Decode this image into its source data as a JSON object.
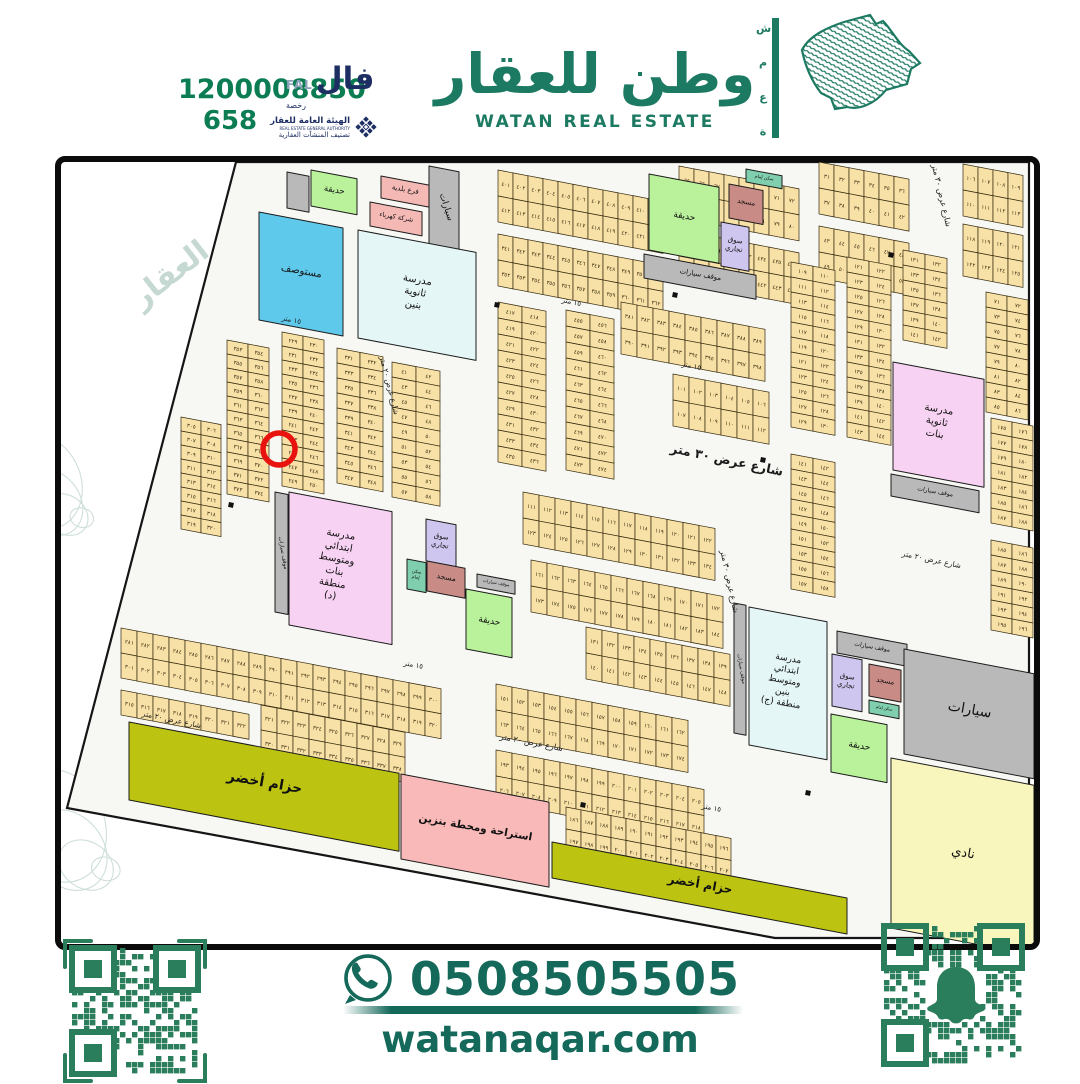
{
  "header": {
    "unified_number": "1200008850",
    "license_number": "658",
    "fal_logo": {
      "arabic": "فال",
      "latin": "FAL",
      "sub": "رخصة"
    },
    "authority": {
      "line1": "الهيئة العامة للعقار",
      "line2": "REAL ESTATE GENERAL AUTHORITY",
      "line3": "تصنيف المنشآت العقارية"
    },
    "brand_title_ar": "وطن للعقار",
    "brand_title_en": "WATAN REAL ESTATE",
    "brand_side_word": [
      "ش",
      "م",
      "ع",
      "ة"
    ],
    "brand_color": "#1d7a62",
    "phone_color": "#0c7d52",
    "navy_color": "#1d2e63"
  },
  "footer": {
    "whatsapp_phone": "0508505505",
    "website": "watanaqar.com",
    "qr_left_name": "qr-code",
    "qr_right_name": "snapchat-qr-code",
    "text_color": "#15695a",
    "qr_color": "#2b7e5c"
  },
  "map": {
    "colors": {
      "parcel": "#f8e1a6",
      "parcel_stroke": "#33290f",
      "street_bg": "#f7f7f4",
      "park": "#b9f29b",
      "clinic": "#5fc9ec",
      "school_cyan": "#e4f6f6",
      "school_pink": "#f8d2f3",
      "mosque": "#c98b85",
      "market": "#cfc6ef",
      "utility_pink": "#f4b9b5",
      "gas": "#f9b9b8",
      "belt": "#bcc411",
      "club": "#f8f6bd",
      "parking": "#b9b9b9",
      "imam": "#7fceae",
      "marker": "#e8120f",
      "watermark": "#9fbfb3"
    },
    "boundary": "175,0 968,0 968,776 714,776 6,646",
    "watermark_text": "العقار",
    "red_circle": {
      "x": 218,
      "y": 287,
      "r": 16
    },
    "facilities": [
      {
        "id": "park-top-left",
        "label": [
          "حديقة"
        ],
        "color": "park",
        "x": 250,
        "y": 8,
        "w": 46,
        "h": 36,
        "fs": 8.5
      },
      {
        "id": "gray-box-top-left",
        "label": [],
        "color": "parking",
        "x": 226,
        "y": 10,
        "w": 22,
        "h": 36,
        "fs": 0
      },
      {
        "id": "municipality-branch",
        "label": [
          "فرع بلدية"
        ],
        "color": "utility_pink",
        "x": 320,
        "y": 14,
        "w": 48,
        "h": 22,
        "fs": 7
      },
      {
        "id": "electricity-company",
        "label": [
          "شركة كهرباء"
        ],
        "color": "utility_pink",
        "x": 309,
        "y": 40,
        "w": 52,
        "h": 24,
        "fs": 6.5
      },
      {
        "id": "parking-strip-top-left",
        "label": [
          "سيارات"
        ],
        "color": "parking",
        "x": 368,
        "y": 4,
        "w": 30,
        "h": 78,
        "fs": 9,
        "lrot": 72
      },
      {
        "id": "clinic",
        "label": [
          "مستوصف"
        ],
        "color": "clinic",
        "x": 198,
        "y": 50,
        "w": 84,
        "h": 108,
        "fs": 10
      },
      {
        "id": "school-boys-high",
        "label": [
          "مدرسة",
          "ثانوية",
          "بنين"
        ],
        "color": "school_cyan",
        "x": 297,
        "y": 68,
        "w": 118,
        "h": 108,
        "fs": 10
      },
      {
        "id": "park-top-center",
        "label": [
          "حديقة"
        ],
        "color": "park",
        "x": 588,
        "y": 12,
        "w": 70,
        "h": 76,
        "fs": 9
      },
      {
        "id": "imam-house-top",
        "label": [
          "سكن إمام"
        ],
        "color": "imam",
        "x": 685,
        "y": 7,
        "w": 36,
        "h": 13,
        "fs": 4.5
      },
      {
        "id": "mosque-top-center",
        "label": [
          "مسجد"
        ],
        "color": "mosque",
        "x": 668,
        "y": 22,
        "w": 34,
        "h": 34,
        "fs": 7
      },
      {
        "id": "market-top-center",
        "label": [
          "سوق",
          "تجاري"
        ],
        "color": "market",
        "x": 660,
        "y": 60,
        "w": 28,
        "h": 44,
        "fs": 7
      },
      {
        "id": "parking-top-center",
        "label": [
          "موقف سيارات"
        ],
        "color": "parking",
        "x": 583,
        "y": 92,
        "w": 112,
        "h": 24,
        "fs": 7
      },
      {
        "id": "school-girls-high",
        "label": [
          "مدرسة",
          "ثانوية",
          "بنات"
        ],
        "color": "school_pink",
        "x": 832,
        "y": 200,
        "w": 91,
        "h": 108,
        "fs": 10
      },
      {
        "id": "parking-girls-school",
        "label": [
          "موقف سيارات"
        ],
        "color": "parking",
        "x": 830,
        "y": 312,
        "w": 88,
        "h": 22,
        "fs": 6
      },
      {
        "id": "school-district-d",
        "label": [
          "مدرسة",
          "ابتدائي",
          "ومتوسط",
          "بنات",
          "منطقة",
          "(د)"
        ],
        "color": "school_pink",
        "x": 228,
        "y": 330,
        "w": 103,
        "h": 133,
        "fs": 10
      },
      {
        "id": "parking-strip-district-d",
        "label": [
          "موقف سيارات"
        ],
        "color": "parking",
        "x": 214,
        "y": 330,
        "w": 13,
        "h": 120,
        "fs": 5.5,
        "lrot": 80
      },
      {
        "id": "market-center",
        "label": [
          "سوق",
          "تجاري"
        ],
        "color": "market",
        "x": 365,
        "y": 357,
        "w": 30,
        "h": 42,
        "fs": 7
      },
      {
        "id": "imam-house-center",
        "label": [
          "سكن",
          "إمام"
        ],
        "color": "imam",
        "x": 346,
        "y": 397,
        "w": 19,
        "h": 30,
        "fs": 4.5
      },
      {
        "id": "mosque-center",
        "label": [
          "مسجد"
        ],
        "color": "mosque",
        "x": 366,
        "y": 399,
        "w": 38,
        "h": 30,
        "fs": 7.5
      },
      {
        "id": "parking-center",
        "label": [
          "موقف سيارات"
        ],
        "color": "parking",
        "x": 416,
        "y": 412,
        "w": 38,
        "h": 13,
        "fs": 4.5
      },
      {
        "id": "park-center",
        "label": [
          "حديقة"
        ],
        "color": "park",
        "x": 405,
        "y": 427,
        "w": 46,
        "h": 60,
        "fs": 9
      },
      {
        "id": "school-district-j",
        "label": [
          "مدرسة",
          "ابتدائي",
          "ومتوسط",
          "بنين",
          "منطقة (ج)"
        ],
        "color": "school_cyan",
        "x": 688,
        "y": 445,
        "w": 78,
        "h": 138,
        "fs": 9
      },
      {
        "id": "parking-strip-district-j",
        "label": [
          "موقف سيارات"
        ],
        "color": "parking",
        "x": 673,
        "y": 441,
        "w": 12,
        "h": 130,
        "fs": 5,
        "lrot": 80
      },
      {
        "id": "parking-district-j",
        "label": [
          "موقف سيارات"
        ],
        "color": "parking",
        "x": 776,
        "y": 469,
        "w": 70,
        "h": 22,
        "fs": 6
      },
      {
        "id": "market-district-j",
        "label": [
          "سوق",
          "تجاري"
        ],
        "color": "market",
        "x": 771,
        "y": 492,
        "w": 30,
        "h": 52,
        "fs": 7
      },
      {
        "id": "mosque-district-j",
        "label": [
          "مسجد"
        ],
        "color": "mosque",
        "x": 808,
        "y": 502,
        "w": 32,
        "h": 32,
        "fs": 7
      },
      {
        "id": "imam-house-district-j",
        "label": [
          "سكن إمام"
        ],
        "color": "imam",
        "x": 808,
        "y": 538,
        "w": 30,
        "h": 13,
        "fs": 4
      },
      {
        "id": "park-district-j",
        "label": [
          "حديقة"
        ],
        "color": "park",
        "x": 770,
        "y": 552,
        "w": 56,
        "h": 58,
        "fs": 9
      },
      {
        "id": "parking-large",
        "label": [
          "سيارات"
        ],
        "color": "parking",
        "x": 843,
        "y": 487,
        "w": 130,
        "h": 105,
        "fs": 14
      },
      {
        "id": "sports-club",
        "label": [
          "نادي"
        ],
        "color": "club",
        "x": 830,
        "y": 596,
        "w": 143,
        "h": 170,
        "fs": 13
      },
      {
        "id": "green-belt-west",
        "label": [
          "حزام أخضر"
        ],
        "color": "belt",
        "x": 68,
        "y": 560,
        "w": 270,
        "h": 78,
        "fs": 14,
        "bold": true
      },
      {
        "id": "gas-station-rest",
        "label": [
          "استراحة ومحطة بنزين"
        ],
        "color": "gas",
        "x": 340,
        "y": 612,
        "w": 148,
        "h": 85,
        "fs": 10.5,
        "bold": true
      },
      {
        "id": "green-belt-south",
        "label": [
          "حزام أخضر"
        ],
        "color": "belt",
        "x": 491,
        "y": 680,
        "w": 295,
        "h": 36,
        "fs": 12,
        "bold": true
      }
    ],
    "street_labels": [
      {
        "t": "شارع عرض ٣٠ متر",
        "x": 665,
        "y": 302,
        "rot": 12,
        "fs": 12.5,
        "bold": true
      },
      {
        "t": "شارع عرض ٣٠ متر",
        "x": 878,
        "y": 34,
        "rot": 77,
        "fs": 8
      },
      {
        "t": "شارع عرض ٣٠ متر",
        "x": 666,
        "y": 420,
        "rot": 78,
        "fs": 8
      },
      {
        "t": "شارع عرض ٢٠ متر",
        "x": 326,
        "y": 224,
        "rot": 76,
        "fs": 7.5
      },
      {
        "t": "شارع عرض ٢٠ متر",
        "x": 470,
        "y": 583,
        "rot": 11,
        "fs": 8
      },
      {
        "t": "شارع عرض ٢٠ متر",
        "x": 110,
        "y": 560,
        "rot": 12,
        "fs": 7.5
      },
      {
        "t": "شارع عرض ٢٠ متر",
        "x": 870,
        "y": 400,
        "rot": 12,
        "fs": 7.5
      },
      {
        "t": "١٥ متر",
        "x": 510,
        "y": 142,
        "rot": 12,
        "fs": 7
      },
      {
        "t": "١٥ متر",
        "x": 630,
        "y": 206,
        "rot": 12,
        "fs": 7
      },
      {
        "t": "١٥ متر",
        "x": 352,
        "y": 505,
        "rot": 11,
        "fs": 7
      },
      {
        "t": "١٥ متر",
        "x": 650,
        "y": 648,
        "rot": 11,
        "fs": 7
      },
      {
        "t": "١٥ متر",
        "x": 230,
        "y": 160,
        "rot": 12,
        "fs": 7
      }
    ],
    "blocks": [
      {
        "id": "V0",
        "x": 120,
        "y": 255,
        "pw": 20,
        "ph": 14,
        "rows": 8,
        "cols": 2,
        "start": 305
      },
      {
        "id": "V1",
        "x": 166,
        "y": 178,
        "pw": 21,
        "ph": 14,
        "rows": 11,
        "cols": 2,
        "start": 353
      },
      {
        "id": "V2",
        "x": 221,
        "y": 170,
        "pw": 21,
        "ph": 14,
        "rows": 11,
        "cols": 2,
        "start": 229
      },
      {
        "id": "V3",
        "x": 276,
        "y": 186,
        "pw": 23,
        "ph": 15,
        "rows": 9,
        "cols": 2,
        "start": 331
      },
      {
        "id": "V4",
        "x": 331,
        "y": 200,
        "pw": 24,
        "ph": 15,
        "rows": 9,
        "cols": 2,
        "start": 41
      },
      {
        "id": "A1",
        "x": 437,
        "y": 8,
        "pw": 15,
        "ph": 26,
        "rows": 2,
        "cols": 11,
        "start": 401
      },
      {
        "id": "A2",
        "x": 618,
        "y": 4,
        "pw": 15,
        "ph": 26,
        "rows": 2,
        "cols": 8,
        "start": 65
      },
      {
        "id": "A3",
        "x": 758,
        "y": 0,
        "pw": 15,
        "ph": 26,
        "rows": 2,
        "cols": 6,
        "start": 31
      },
      {
        "id": "A4",
        "x": 902,
        "y": 2,
        "pw": 15,
        "ph": 26,
        "rows": 2,
        "cols": 4,
        "start": 106
      },
      {
        "id": "B1",
        "x": 437,
        "y": 72,
        "pw": 15,
        "ph": 26,
        "rows": 2,
        "cols": 11,
        "start": 341
      },
      {
        "id": "B2",
        "x": 618,
        "y": 68,
        "pw": 15,
        "ph": 26,
        "rows": 2,
        "cols": 8,
        "start": 429
      },
      {
        "id": "B3",
        "x": 758,
        "y": 64,
        "pw": 15,
        "ph": 26,
        "rows": 2,
        "cols": 6,
        "start": 43
      },
      {
        "id": "B4",
        "x": 902,
        "y": 62,
        "pw": 15,
        "ph": 26,
        "rows": 2,
        "cols": 4,
        "start": 118
      },
      {
        "id": "C1",
        "x": 437,
        "y": 140,
        "pw": 24,
        "ph": 16,
        "rows": 10,
        "cols": 2,
        "start": 417
      },
      {
        "id": "C2",
        "x": 505,
        "y": 148,
        "pw": 24,
        "ph": 16,
        "rows": 10,
        "cols": 2,
        "start": 455
      },
      {
        "id": "C3",
        "x": 560,
        "y": 140,
        "pw": 16,
        "ph": 26,
        "rows": 2,
        "cols": 9,
        "start": 381
      },
      {
        "id": "M3",
        "x": 612,
        "y": 212,
        "pw": 16,
        "ph": 26,
        "rows": 2,
        "cols": 6,
        "start": 101
      },
      {
        "id": "H9",
        "x": 462,
        "y": 330,
        "pw": 16,
        "ph": 26,
        "rows": 2,
        "cols": 12,
        "start": 111
      },
      {
        "id": "H10",
        "x": 470,
        "y": 398,
        "pw": 16,
        "ph": 26,
        "rows": 2,
        "cols": 12,
        "start": 161
      },
      {
        "id": "H11",
        "x": 525,
        "y": 465,
        "pw": 16,
        "ph": 26,
        "rows": 2,
        "cols": 9,
        "start": 131
      },
      {
        "id": "R1",
        "x": 730,
        "y": 100,
        "pw": 22,
        "ph": 15,
        "rows": 11,
        "cols": 2,
        "start": 109
      },
      {
        "id": "R2",
        "x": 786,
        "y": 95,
        "pw": 22,
        "ph": 15,
        "rows": 12,
        "cols": 2,
        "start": 121
      },
      {
        "id": "R3",
        "x": 842,
        "y": 88,
        "pw": 22,
        "ph": 15,
        "rows": 6,
        "cols": 2,
        "start": 131
      },
      {
        "id": "R4",
        "x": 925,
        "y": 130,
        "pw": 21,
        "ph": 15,
        "rows": 8,
        "cols": 2,
        "start": 71
      },
      {
        "id": "R5",
        "x": 930,
        "y": 256,
        "pw": 21,
        "ph": 15,
        "rows": 7,
        "cols": 2,
        "start": 175
      },
      {
        "id": "R6",
        "x": 730,
        "y": 292,
        "pw": 22,
        "ph": 15,
        "rows": 9,
        "cols": 2,
        "start": 141
      },
      {
        "id": "R7",
        "x": 930,
        "y": 378,
        "pw": 21,
        "ph": 15,
        "rows": 6,
        "cols": 2,
        "start": 185
      },
      {
        "id": "H0",
        "x": 60,
        "y": 466,
        "pw": 16,
        "ph": 25,
        "rows": 2,
        "cols": 20,
        "start": 281
      },
      {
        "id": "H1",
        "x": 60,
        "y": 528,
        "pw": 16,
        "ph": 25,
        "rows": 1,
        "cols": 8,
        "start": 315
      },
      {
        "id": "H3",
        "x": 200,
        "y": 543,
        "pw": 16,
        "ph": 25,
        "rows": 2,
        "cols": 9,
        "start": 321
      },
      {
        "id": "H5",
        "x": 435,
        "y": 522,
        "pw": 16,
        "ph": 26,
        "rows": 2,
        "cols": 12,
        "start": 151
      },
      {
        "id": "H6",
        "x": 435,
        "y": 588,
        "pw": 16,
        "ph": 26,
        "rows": 2,
        "cols": 13,
        "start": 193
      },
      {
        "id": "H8",
        "x": 505,
        "y": 645,
        "pw": 15,
        "ph": 22,
        "rows": 2,
        "cols": 11,
        "start": 186
      }
    ],
    "utility_markers": [
      [
        168,
        340
      ],
      [
        434,
        140
      ],
      [
        612,
        130
      ],
      [
        700,
        295
      ],
      [
        828,
        90
      ],
      [
        520,
        640
      ],
      [
        745,
        628
      ]
    ]
  }
}
